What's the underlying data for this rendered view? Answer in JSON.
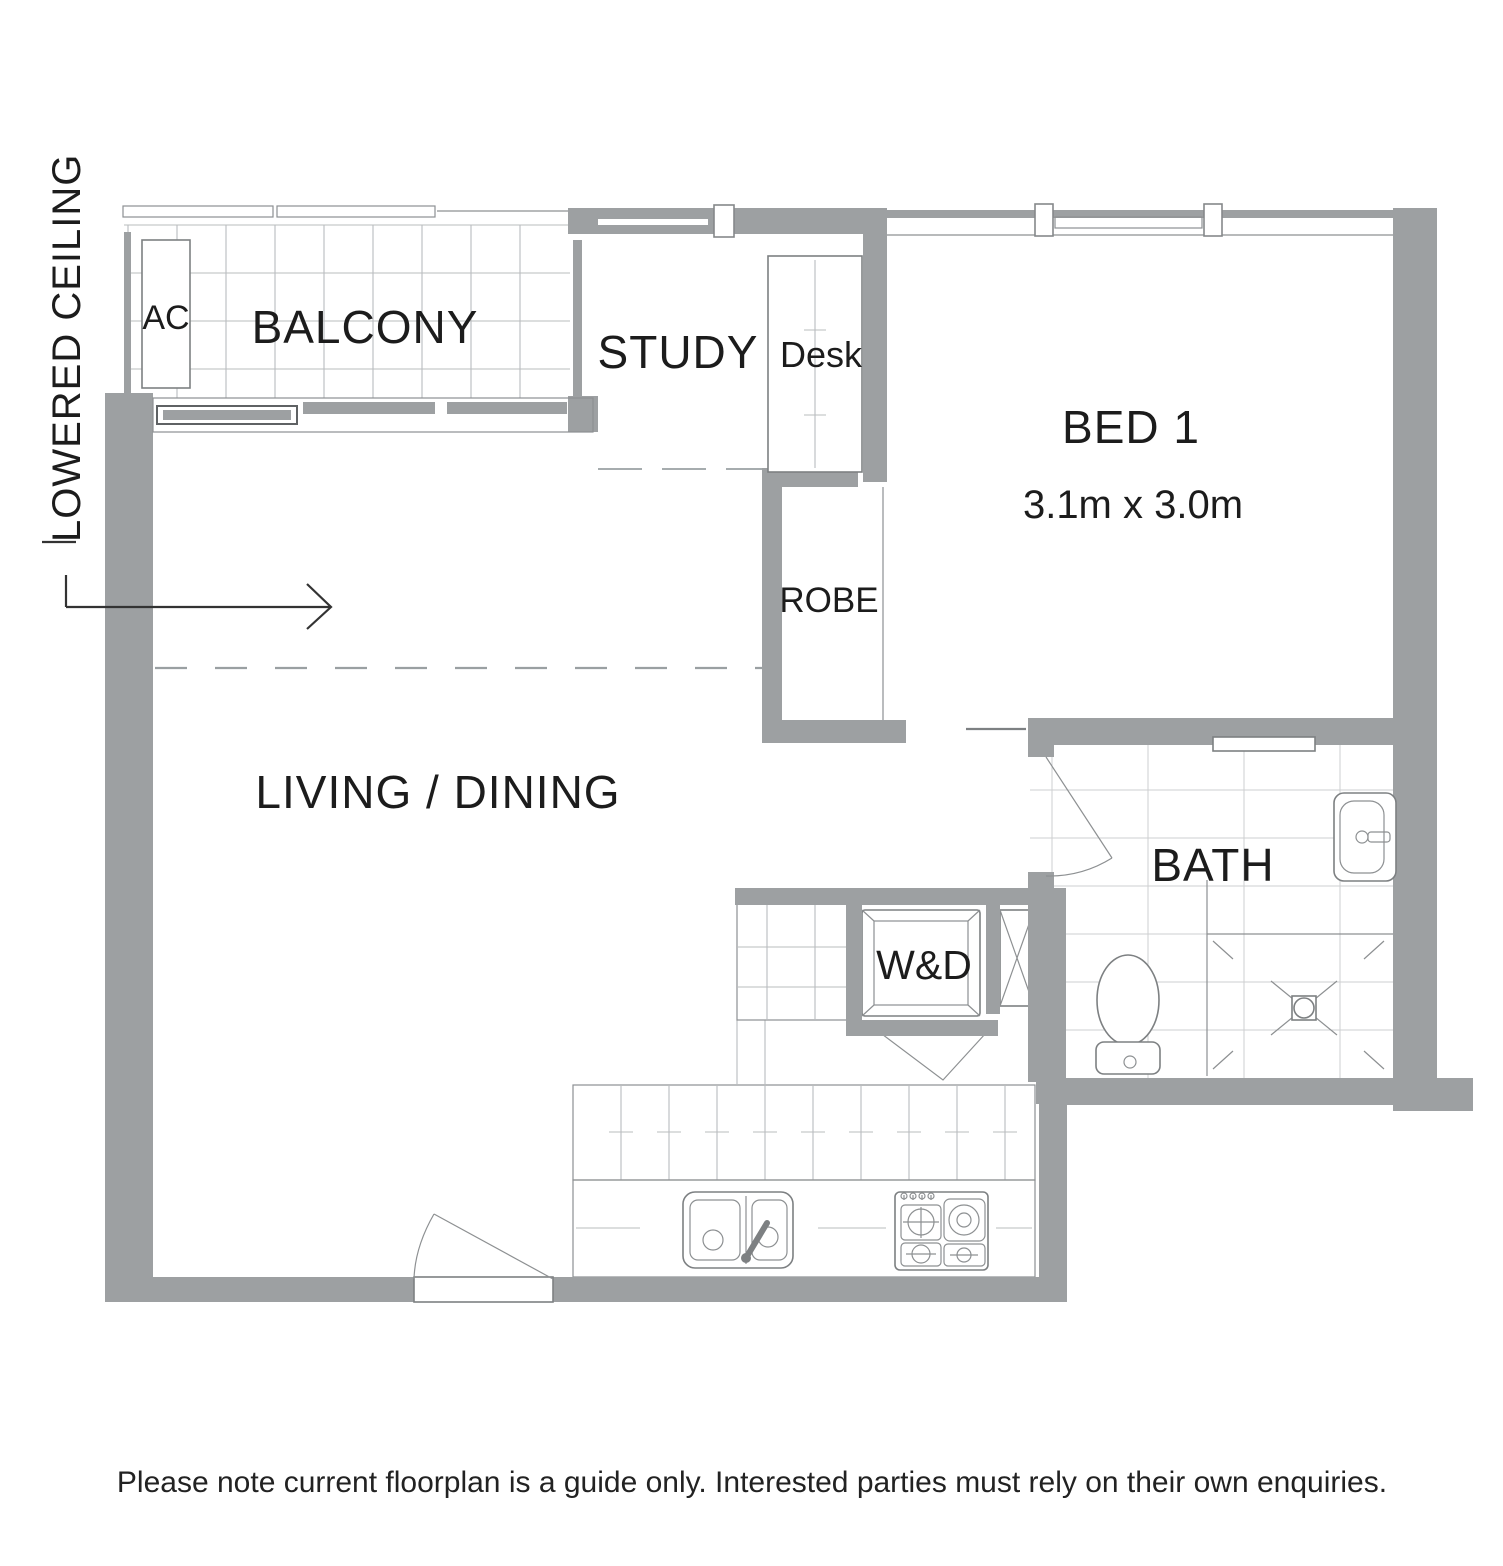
{
  "plan": {
    "lowered_ceiling": "LOWERED CEILING",
    "balcony": {
      "label": "BALCONY",
      "ac": "AC"
    },
    "study": {
      "label": "STUDY",
      "desk": "Desk"
    },
    "bed1": {
      "label": "BED 1",
      "dims": "3.1m x 3.0m"
    },
    "robe": {
      "label": "ROBE"
    },
    "living": {
      "label": "LIVING / DINING"
    },
    "bath": {
      "label": "BATH"
    },
    "laundry": {
      "wd": "W&D"
    }
  },
  "disclaimer": "Please note current floorplan is a guide only. Interested parties must rely on their own enquiries.",
  "colors": {
    "wall": "#9da0a2",
    "line": "#85888a",
    "grid": "#c6c8ca",
    "text": "#1c1c1c",
    "background": "#ffffff"
  }
}
